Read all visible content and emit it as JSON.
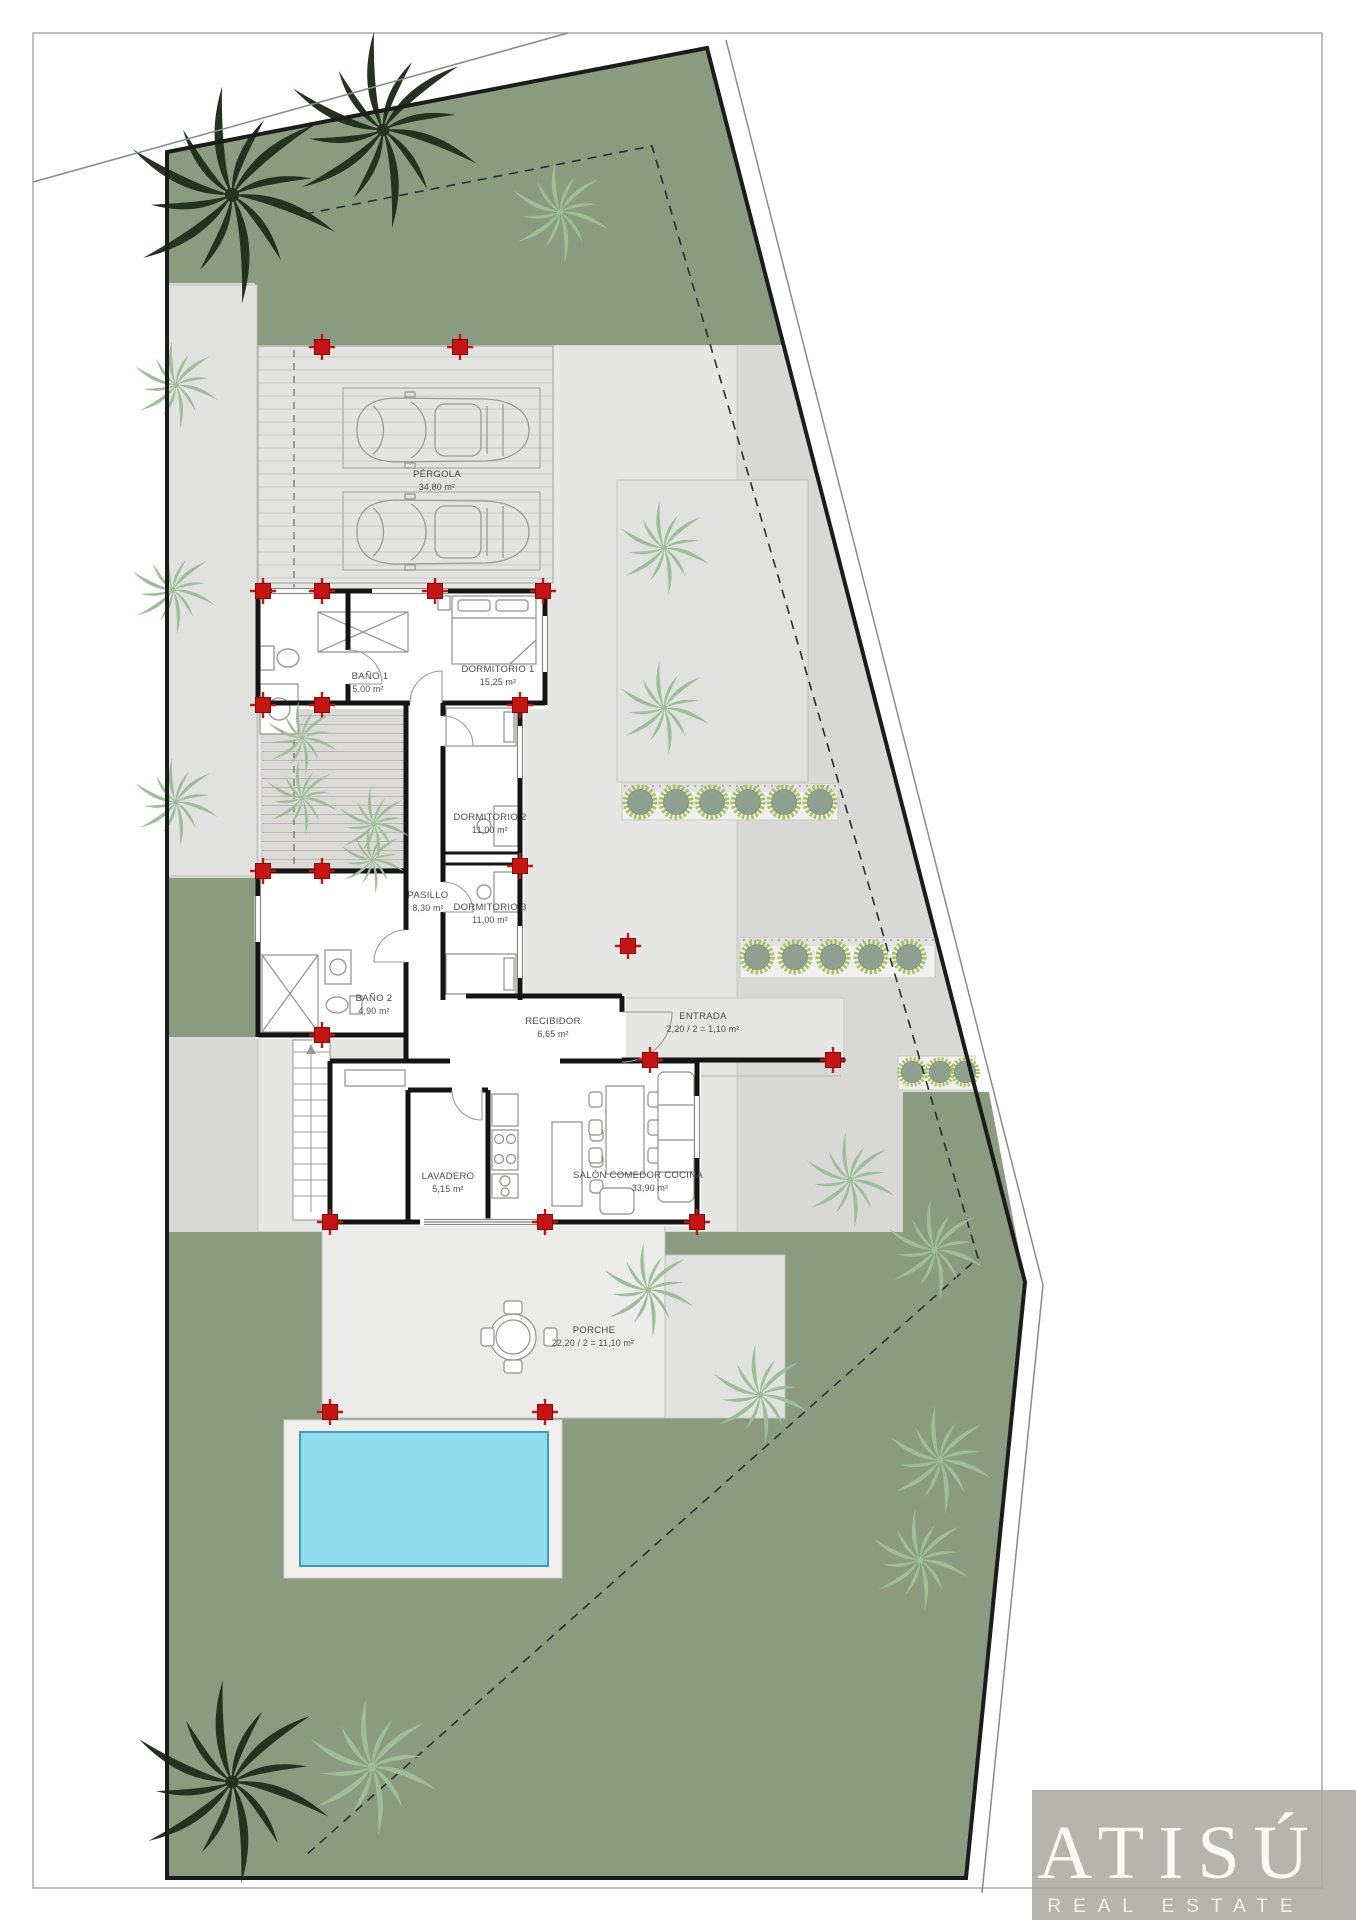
{
  "plan": {
    "rooms": [
      {
        "id": "pergola",
        "name": "PÉRGOLA",
        "area": "34,80 m²"
      },
      {
        "id": "banio1",
        "name": "BAÑO 1",
        "area": "5,00 m²"
      },
      {
        "id": "dormitorio1",
        "name": "DORMITORIO 1",
        "area": "15,25 m²"
      },
      {
        "id": "dormitorio2",
        "name": "DORMITORIO 2",
        "area": "11,00 m²"
      },
      {
        "id": "pasillo",
        "name": "PASILLO",
        "area": "8,30 m²"
      },
      {
        "id": "dormitorio3",
        "name": "DORMITORIO 3",
        "area": "11,00 m²"
      },
      {
        "id": "banio2",
        "name": "BAÑO 2",
        "area": "4,90 m²"
      },
      {
        "id": "recibidor",
        "name": "RECIBIDOR",
        "area": "6,65 m²"
      },
      {
        "id": "entrada",
        "name": "ENTRADA",
        "area": "2,20 / 2 = 1,10 m²"
      },
      {
        "id": "lavadero",
        "name": "LAVADERO",
        "area": "5,15 m²"
      },
      {
        "id": "salon",
        "name": "SALÓN COMEDOR COCINA",
        "area": "33,90 m²"
      },
      {
        "id": "porche",
        "name": "PORCHE",
        "area": "22,20 / 2 = 11,10 m²"
      }
    ]
  },
  "branding": {
    "logo_text": "ATISÚ",
    "logo_subtext": "REAL ESTATE"
  },
  "colors": {
    "garden_green": "#8a9b80",
    "bush_green": "#a6c25f",
    "pool_water": "#8edcec",
    "column_marker_red": "#c41414",
    "logo_background": "#b7b4af"
  }
}
